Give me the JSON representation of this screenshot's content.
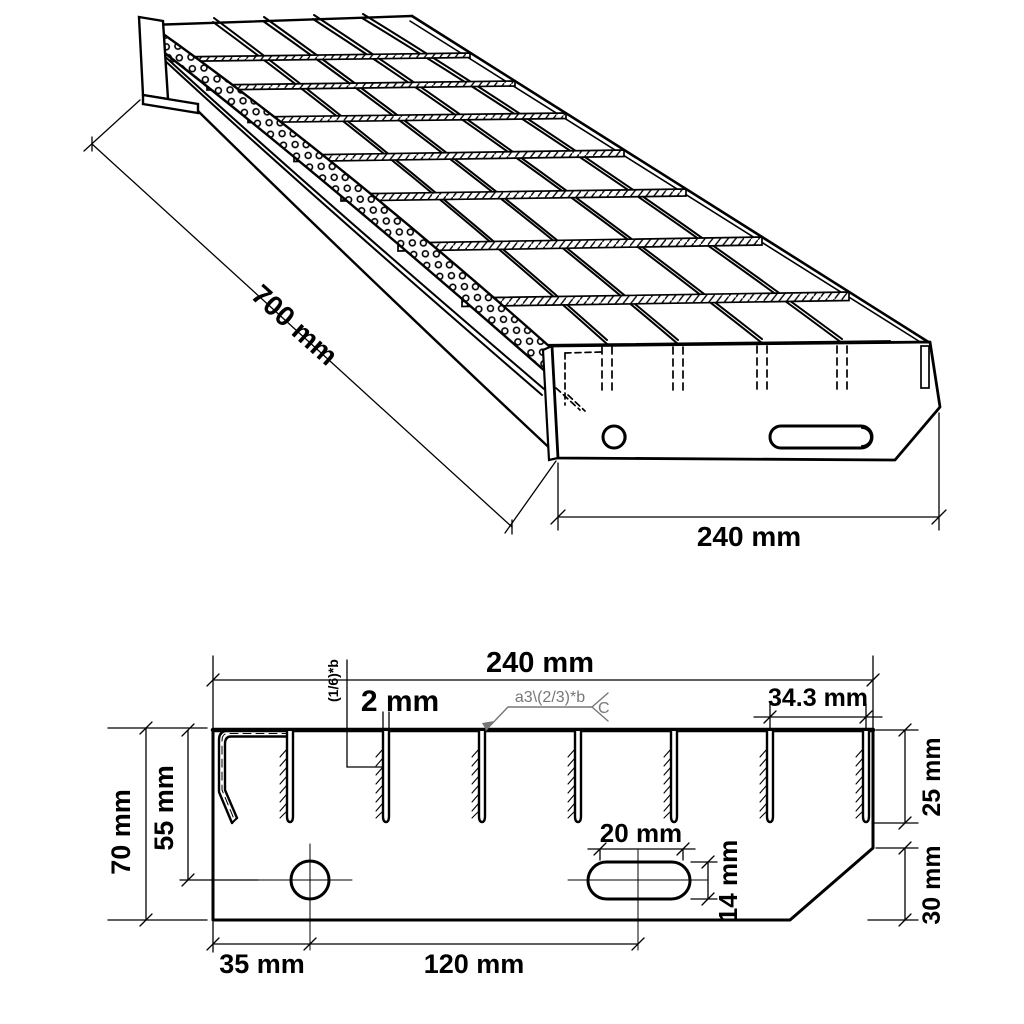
{
  "drawing": {
    "type": "technical-drawing",
    "subject": "steel grating stair tread with perforated nosing and end plates",
    "colors": {
      "line": "#000000",
      "background": "#ffffff",
      "weld_note": "#777777"
    }
  },
  "iso": {
    "dim_length": "700 mm",
    "dim_width": "240 mm"
  },
  "section": {
    "dim_width": "240 mm",
    "dim_bar_thickness": "2 mm",
    "note_rotated": "(1/6)*b",
    "weld_text": "a3\\(2/3)*b",
    "weld_tail": "C",
    "dim_bar_spacing": "34.3 mm",
    "dim_bar_depth": "25 mm",
    "dim_chamfer": "30 mm",
    "dim_plate_height": "70 mm",
    "dim_hole_center_y": "55 mm",
    "dim_hole_center_x": "35 mm",
    "dim_slot_center_x": "120 mm",
    "dim_slot_length": "20 mm",
    "dim_slot_height": "14 mm"
  }
}
